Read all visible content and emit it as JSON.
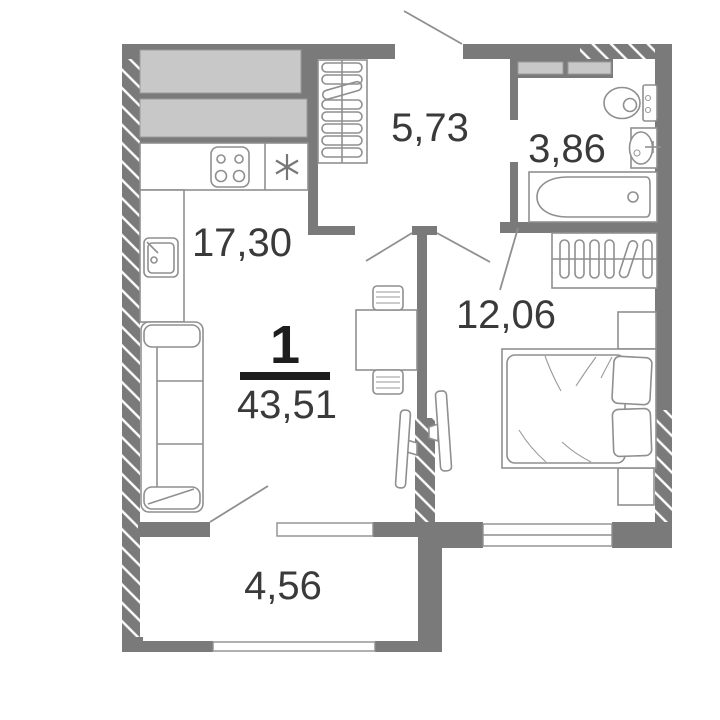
{
  "plan": {
    "type": "apartment-floor-plan",
    "unit_rooms_count": "1",
    "total_area": "43,51",
    "rooms": {
      "kitchen_living": {
        "area": "17,30"
      },
      "hallway": {
        "area": "5,73"
      },
      "bathroom": {
        "area": "3,86"
      },
      "bedroom": {
        "area": "12,06"
      },
      "balcony": {
        "area": "4,56"
      }
    },
    "fixtures": [
      "kitchen-cabinets",
      "stove-4-burners",
      "appliance-star",
      "kitchen-sink",
      "coat-hangers-closet",
      "toilet",
      "washbasin",
      "bathtub",
      "wardrobe-hangers",
      "double-bed",
      "pillows",
      "nightstands",
      "tv-living",
      "tv-bedroom",
      "dining-table",
      "chairs",
      "sofa"
    ],
    "colors": {
      "wall": "#7a7a7a",
      "cabinet_fill": "#c8c8c8",
      "furniture_stroke": "#8f8f8f",
      "label_text": "#3a3a3a",
      "accent_text": "#1d1d1d",
      "background": "#ffffff"
    }
  }
}
